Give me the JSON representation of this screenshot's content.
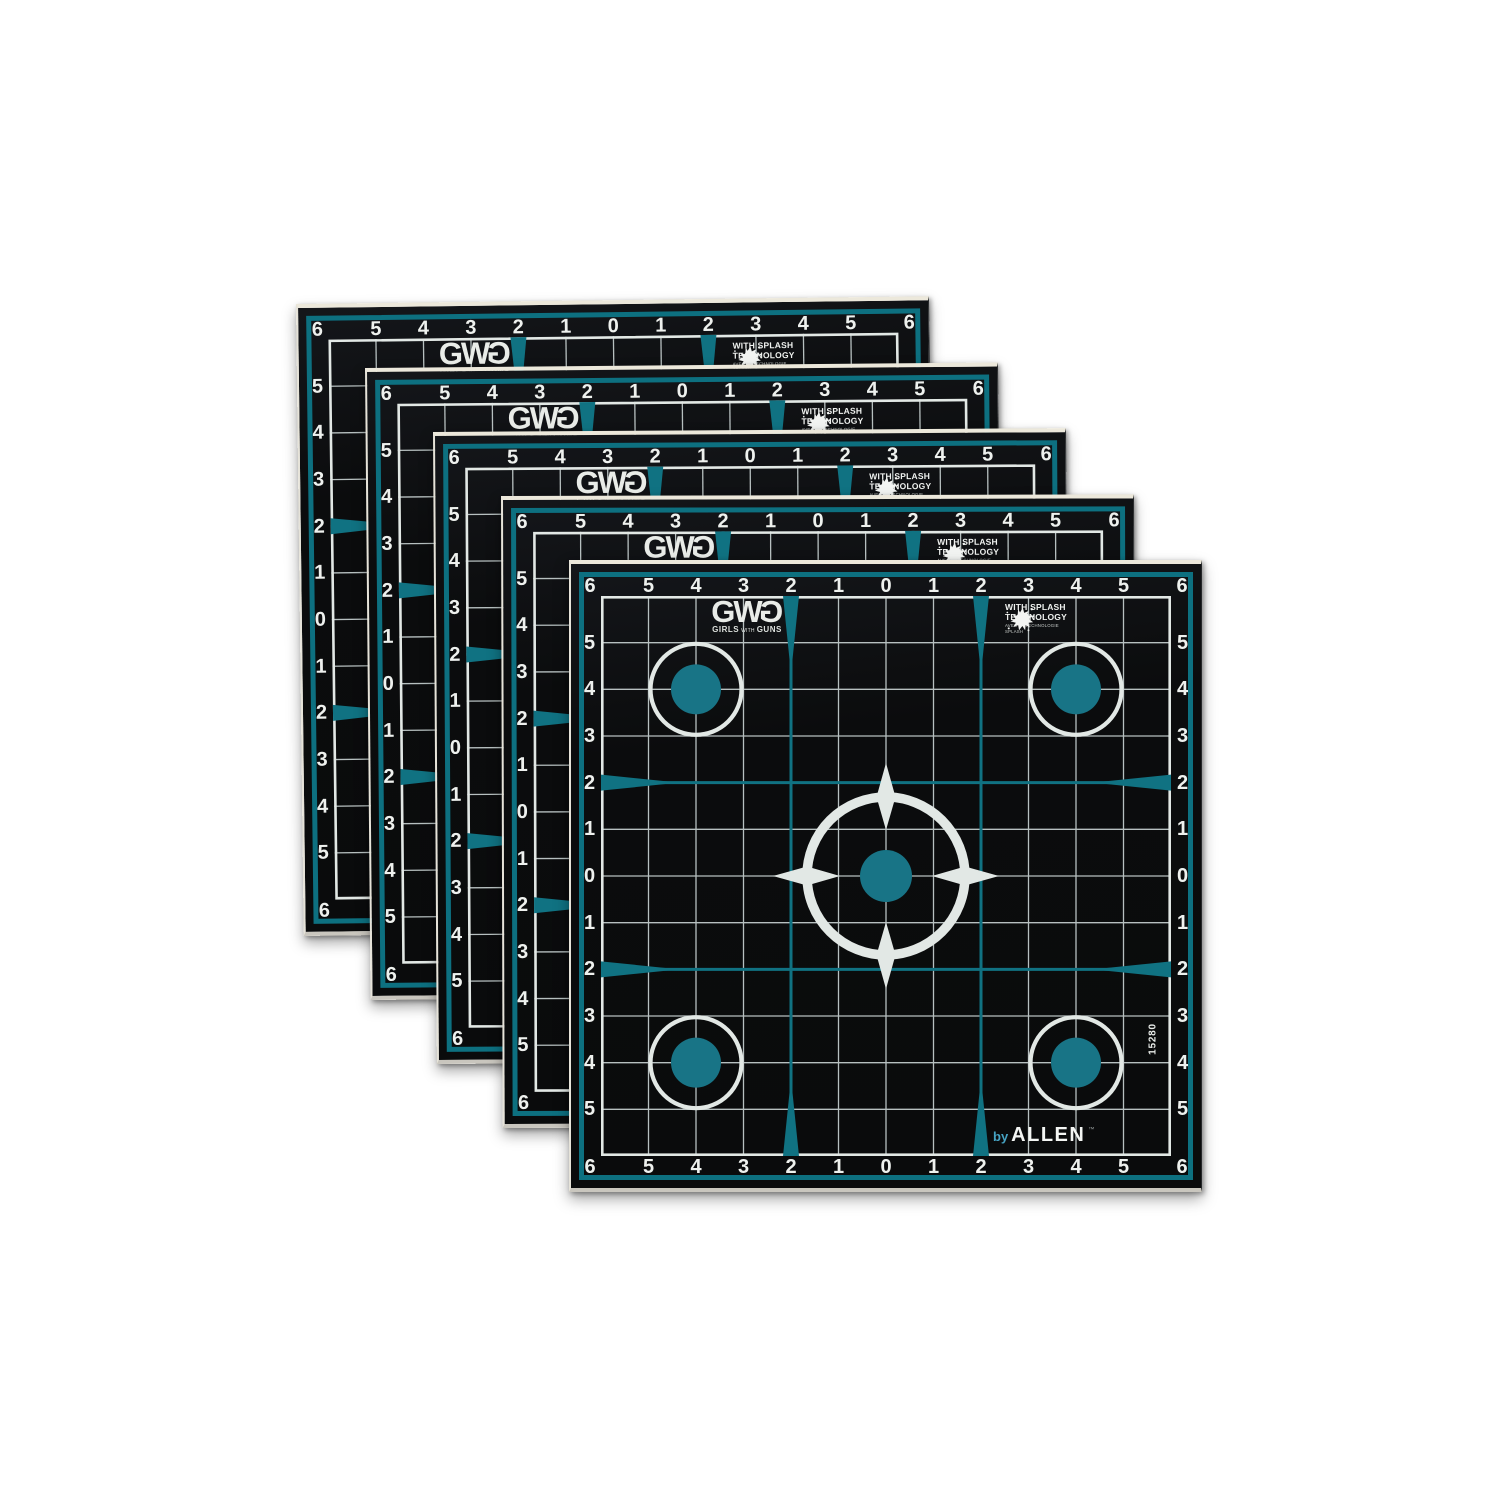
{
  "scene": {
    "background_color": "#ffffff"
  },
  "stack": {
    "count": 5
  },
  "sheet": {
    "colors": {
      "paper_black": "#0c0d0e",
      "teal": "#107282",
      "teal_dot": "#187486",
      "grid_line": "#b7c0c0",
      "grid_border": "#e2e8e5",
      "number_white": "#eef1ee",
      "border_ring_teal": "#0d7080",
      "paper_edge_top": "#ece8db",
      "paper_edge_bottom": "#c9c6be",
      "brand_blue": "#46a3c3"
    },
    "axis_labels": [
      "6",
      "5",
      "4",
      "3",
      "2",
      "1",
      "0",
      "1",
      "2",
      "3",
      "4",
      "5",
      "6"
    ],
    "logo": {
      "l1": "G",
      "l2": "W",
      "l3": "G",
      "sub_girls": "GIRLS",
      "sub_with": "WITH",
      "sub_guns": "GUNS"
    },
    "splash": {
      "line1": "WITH SPLASH",
      "line2": "TECHNOLOGY",
      "sub1": "AVEC LA TECHNOLOGIE",
      "sub2": "SPLASH"
    },
    "brand": {
      "prefix": "by",
      "name": "ALLEN",
      "tm": "™"
    },
    "item_number": "15280"
  }
}
